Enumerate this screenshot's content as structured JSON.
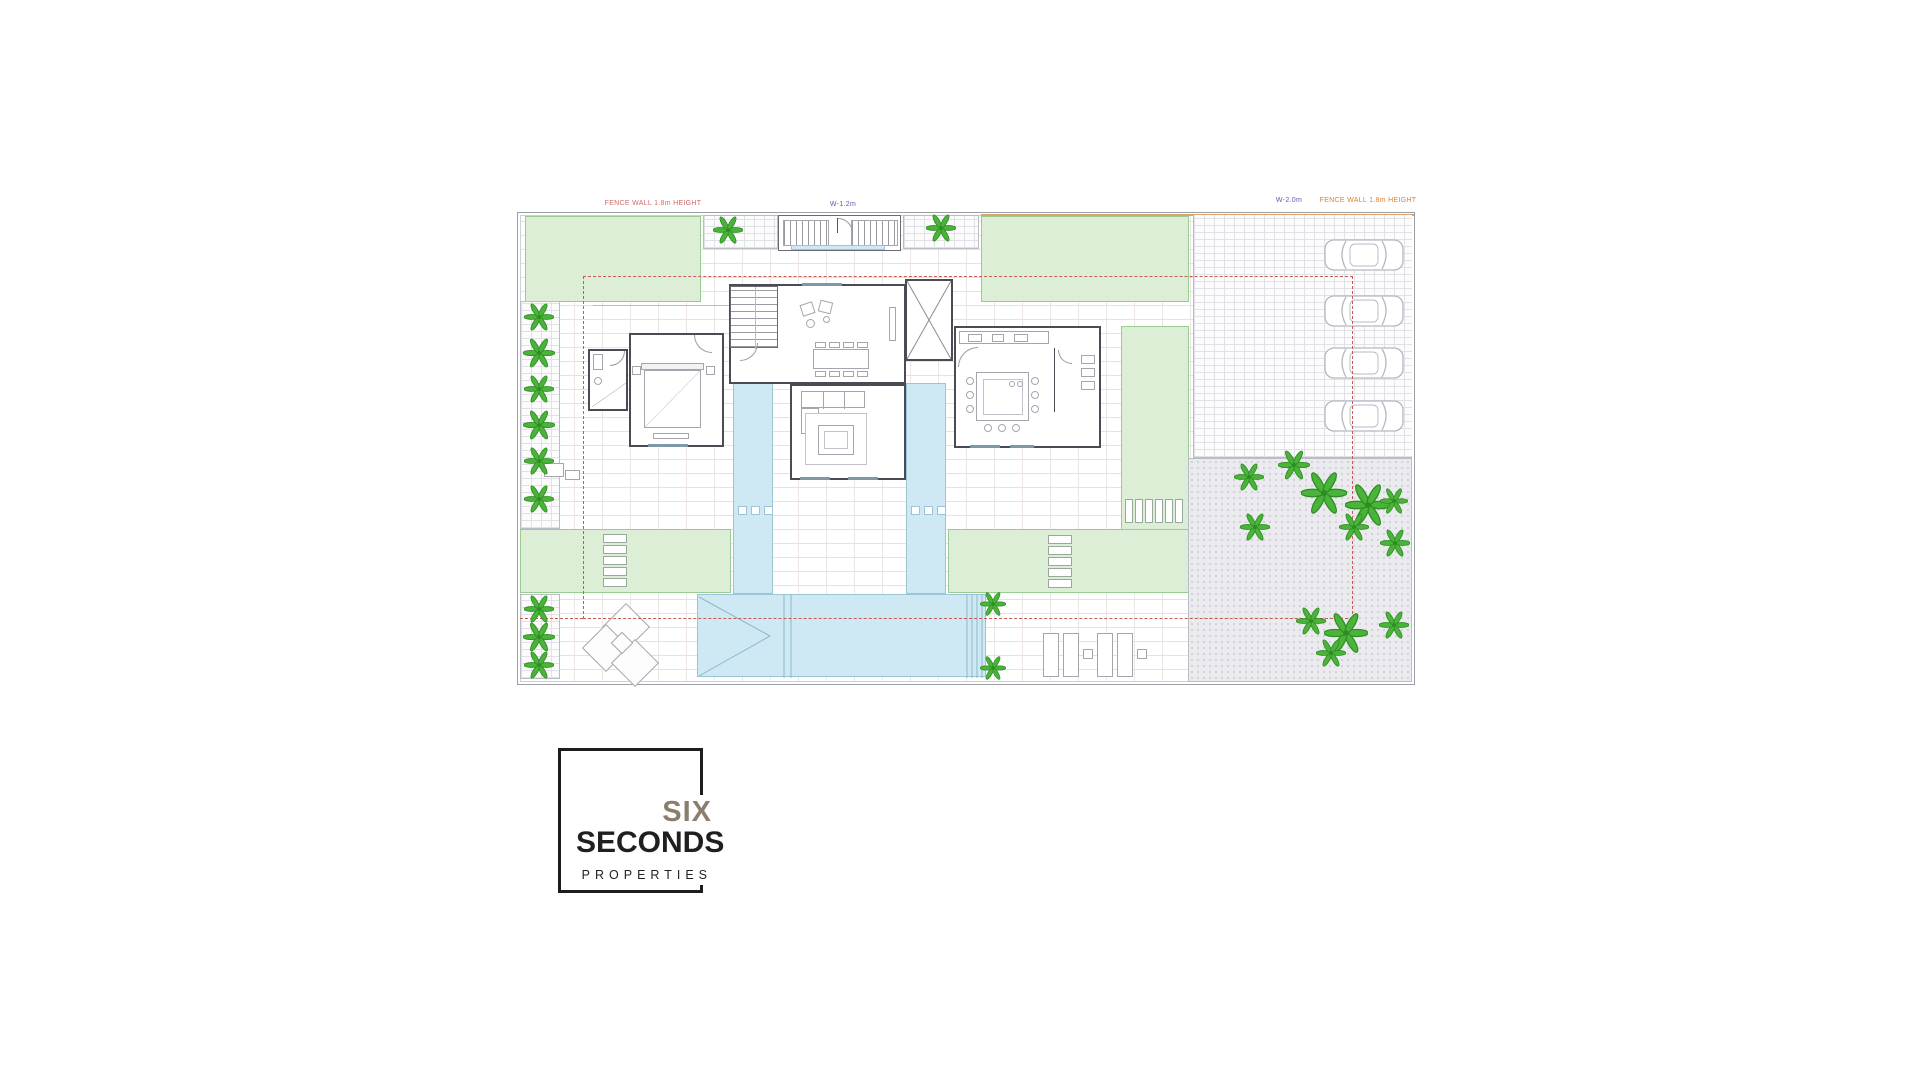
{
  "plan": {
    "labels": {
      "fence_left": "FENCE WALL 1.8m HEIGHT",
      "entry_gate_width": "W-1.2m",
      "drive_gate_width": "W-2.0m",
      "fence_right": "FENCE WALL 1.8m HEIGHT"
    }
  },
  "logo": {
    "brand_top": "SIX",
    "brand_bottom": "SECONDS",
    "tagline": "PROPERTIES"
  },
  "icons": {
    "palm": "palm-tree-icon",
    "car": "car-icon"
  },
  "colors": {
    "lawn": "#dcefd6",
    "water": "#cfe9f4",
    "palm_green": "#4ab339",
    "setback_red": "#c65b52",
    "fence_orange": "#dca468",
    "wall": "#4b4b55",
    "logo_gray": "#8a7f6e",
    "logo_black": "#1f1f1d"
  }
}
